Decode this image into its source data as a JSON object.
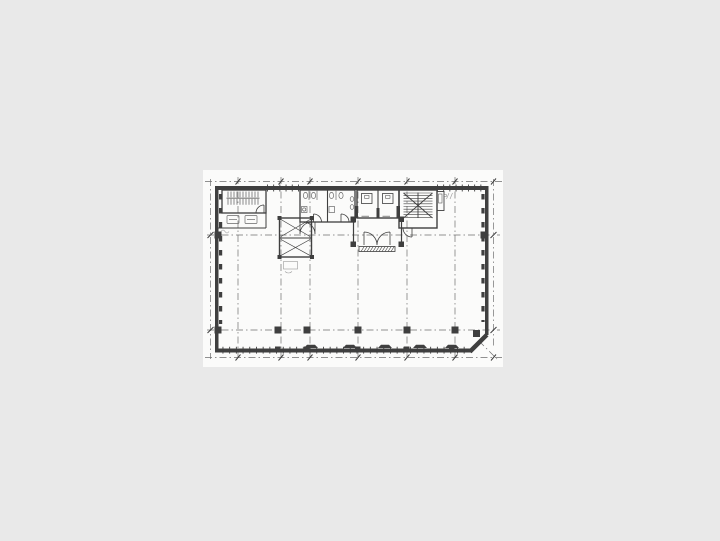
{
  "page": {
    "background_color": "#e9e9e9"
  },
  "sheet": {
    "color": "#fbfbfa"
  },
  "drawing": {
    "kind": "scanned building floor plan",
    "ink_color": "#3f3f3f",
    "grid_color": "#6e6e6e",
    "fixture_color": "#6a6a6a",
    "faint_color": "#989898",
    "features": [
      {
        "name": "northwest-stairwell"
      },
      {
        "name": "service-shaft",
        "cells": 2
      },
      {
        "name": "restroom-left"
      },
      {
        "name": "restroom-right"
      },
      {
        "name": "elevator-bank",
        "elevator_count": 2
      },
      {
        "name": "elevator-hall"
      },
      {
        "name": "northeast-stairwell"
      },
      {
        "name": "open-floor-area"
      },
      {
        "name": "structural-grid",
        "vertical_lines": 6,
        "horizontal_lines": 2
      },
      {
        "name": "interior-columns",
        "count": 5
      },
      {
        "name": "perimeter-window-mullions"
      },
      {
        "name": "fan-coil-units",
        "count": 5
      },
      {
        "name": "chamfered-southeast-corner"
      }
    ]
  }
}
